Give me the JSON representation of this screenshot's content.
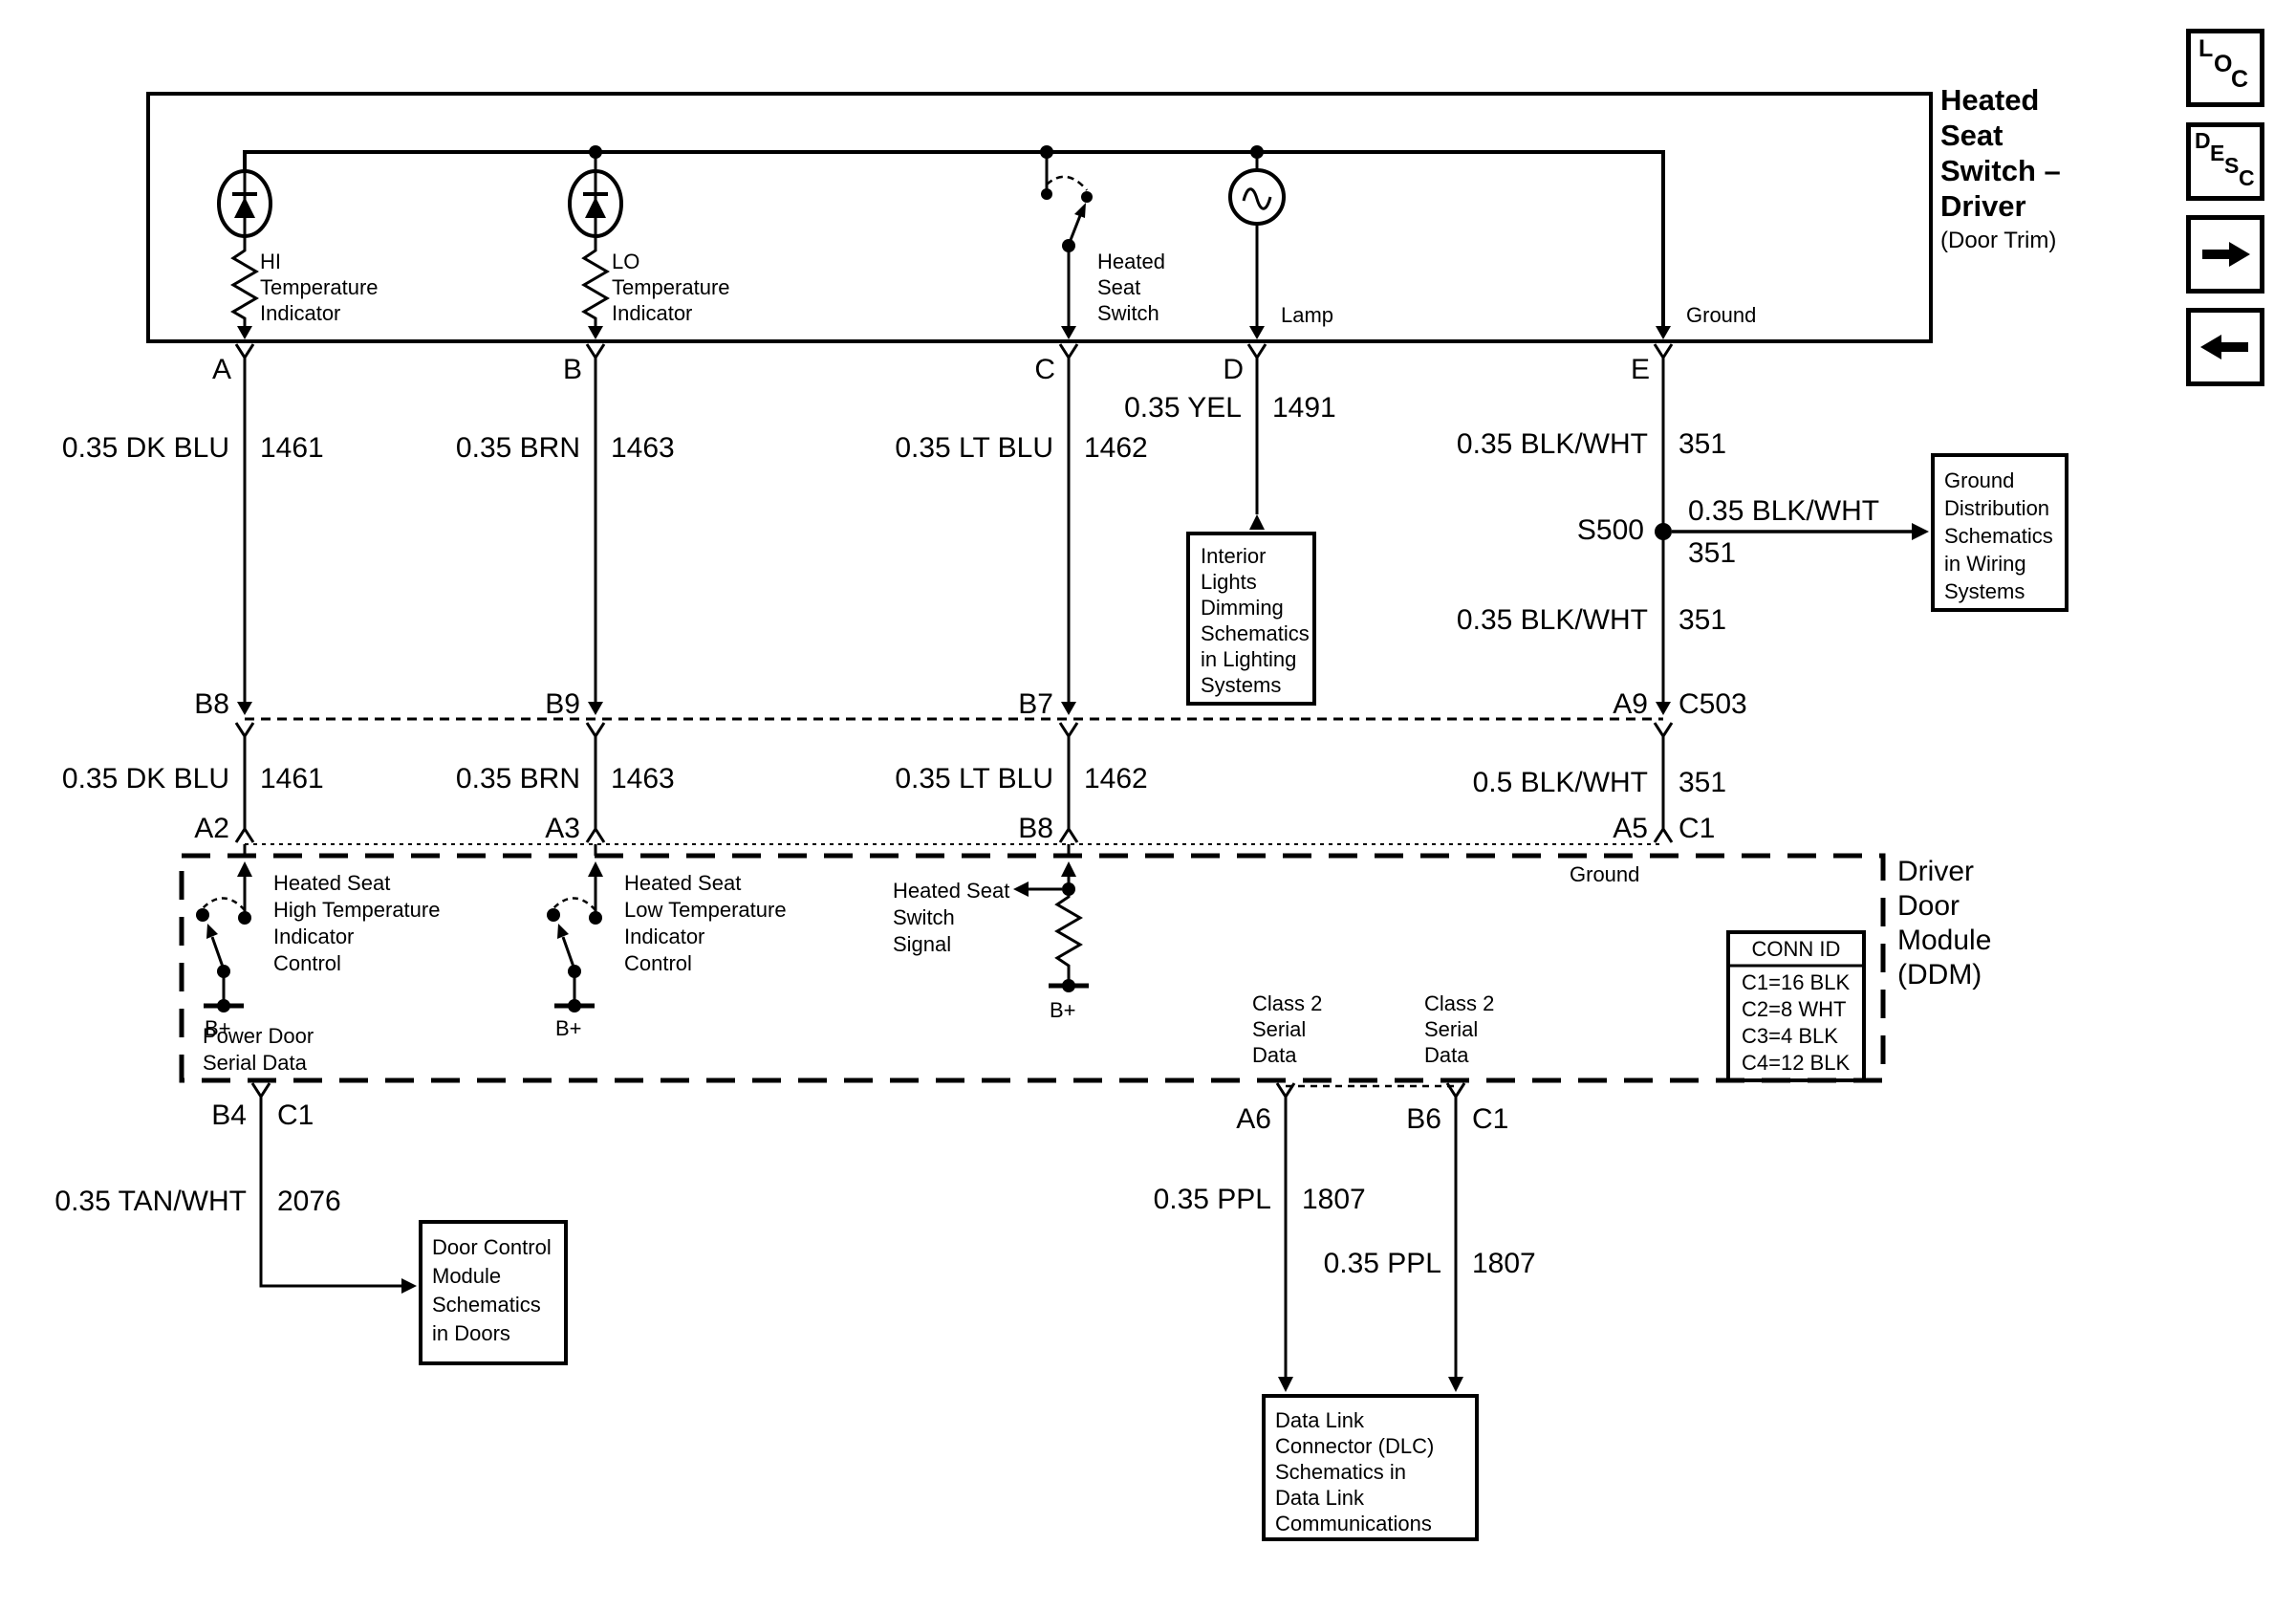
{
  "title_block": {
    "title": "Heated\nSeat\nSwitch –\nDriver",
    "subtitle": "(Door Trim)"
  },
  "nav": {
    "loc": [
      "L",
      "O",
      "C"
    ],
    "desc": [
      "D",
      "E",
      "S",
      "C"
    ]
  },
  "top_box": {
    "pin_a": "A",
    "pin_b": "B",
    "pin_c": "C",
    "pin_d": "D",
    "pin_e": "E",
    "hi_indicator": "HI\nTemperature\nIndicator",
    "lo_indicator": "LO\nTemperature\nIndicator",
    "switch_label": "Heated\nSeat\nSwitch",
    "lamp_label": "Lamp",
    "ground_label": "Ground"
  },
  "seg1": {
    "a_color": "0.35 DK BLU",
    "a_circuit": "1461",
    "b_color": "0.35 BRN",
    "b_circuit": "1463",
    "c_color": "0.35 LT BLU",
    "c_circuit": "1462",
    "d_color": "0.35 YEL",
    "d_circuit": "1491",
    "e_color": "0.35 BLK/WHT",
    "e_circuit": "351"
  },
  "s500": {
    "label": "S500",
    "branch_color": "0.35 BLK/WHT",
    "branch_circuit": "351",
    "lower_color": "0.35 BLK/WHT",
    "lower_circuit": "351"
  },
  "c503": {
    "pin_a": "B8",
    "pin_b": "B9",
    "pin_c": "B7",
    "pin_e": "A9",
    "name": "C503"
  },
  "seg2": {
    "a_color": "0.35 DK BLU",
    "a_circuit": "1461",
    "b_color": "0.35 BRN",
    "b_circuit": "1463",
    "c_color": "0.35 LT BLU",
    "c_circuit": "1462",
    "e_color": "0.5 BLK/WHT",
    "e_circuit": "351"
  },
  "c1_row": {
    "pin_a": "A2",
    "pin_b": "A3",
    "pin_c": "B8",
    "pin_e": "A5",
    "name": "C1"
  },
  "ddm": {
    "label": "Driver\nDoor\nModule\n(DDM)",
    "ground_label": "Ground",
    "hi_control": "Heated Seat\nHigh Temperature\nIndicator\nControl",
    "lo_control": "Heated Seat\nLow Temperature\nIndicator\nControl",
    "switch_signal": "Heated Seat\nSwitch\nSignal",
    "bplus_1": "B+",
    "bplus_2": "B+",
    "bplus_3": "B+",
    "power_door": "Power Door\nSerial Data",
    "class2_a": "Class 2\nSerial\nData",
    "class2_b": "Class 2\nSerial\nData",
    "conn_id_header": "CONN ID",
    "conn_id_rows": "C1=16 BLK\nC2=8 WHT\nC3=4 BLK\nC4=12 BLK",
    "pin_b4": "B4",
    "pin_b4_conn": "C1",
    "pin_a6": "A6",
    "pin_b6": "B6",
    "pin_b6_conn": "C1"
  },
  "seg3": {
    "b4_color": "0.35 TAN/WHT",
    "b4_circuit": "2076",
    "a6_color": "0.35 PPL",
    "a6_circuit": "1807",
    "b6_color": "0.35 PPL",
    "b6_circuit": "1807"
  },
  "ref_boxes": {
    "interior_lights": "Interior\nLights\nDimming\nSchematics\nin Lighting\nSystems",
    "ground_dist": "Ground\nDistribution\nSchematics\nin Wiring\nSystems",
    "door_control": "Door Control\nModule\nSchematics\nin Doors",
    "dlc": "Data Link\nConnector (DLC)\nSchematics in\nData Link\nCommunications"
  }
}
